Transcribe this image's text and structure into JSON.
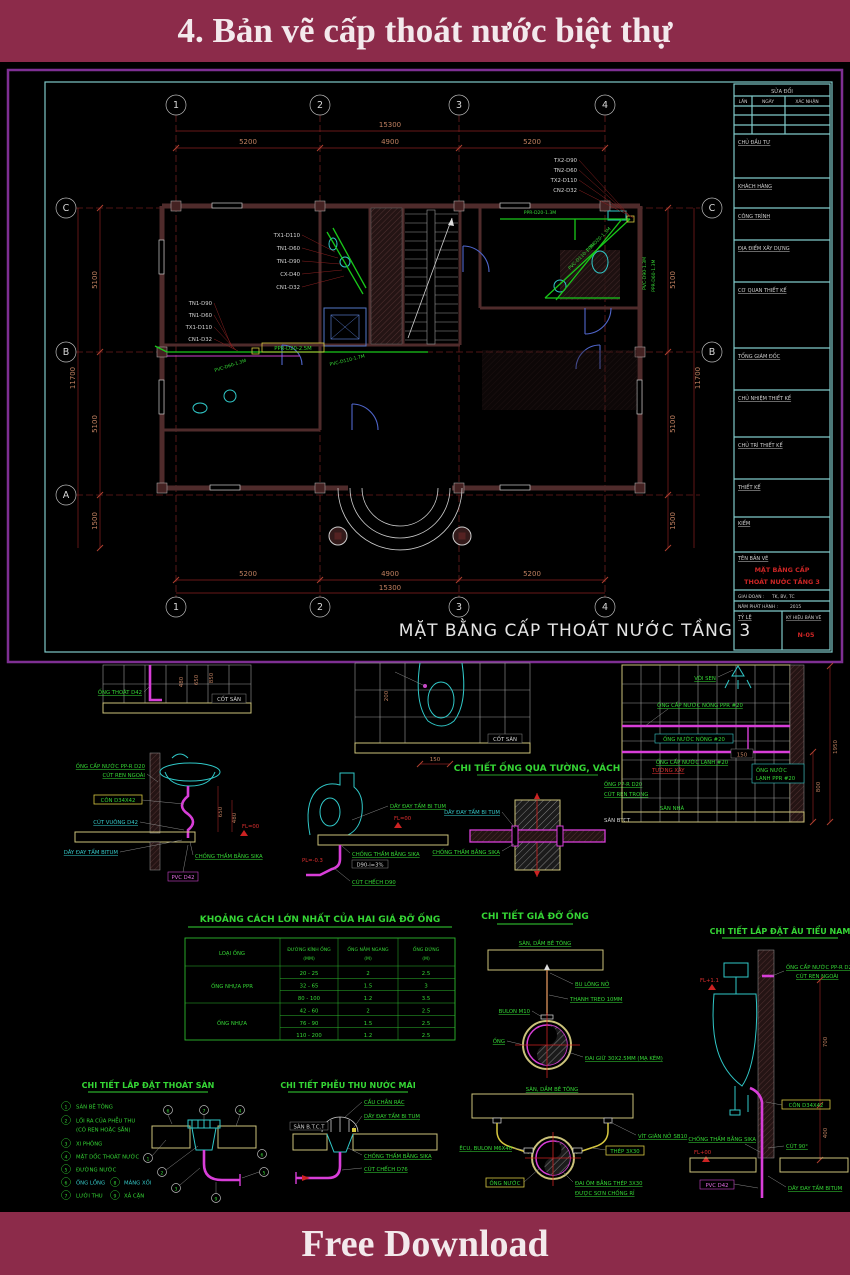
{
  "banner_top": {
    "title": "4. Bản vẽ cấp thoát nước biệt thự"
  },
  "banner_bottom": {
    "title": "Free Download"
  },
  "colors": {
    "banner": "#8c2b4a",
    "sheet_border": "#7e2f93",
    "frame": "#7fc9c9",
    "pipe_green": "#19c819",
    "pipe_magenta": "#d83ed8",
    "fixture_cyan": "#30c8c8",
    "label_green": "#35d635",
    "dim_text": "#c08060",
    "red_text": "#cc2525",
    "slab_yellow": "#cbc27a"
  },
  "titleblock": {
    "revision_header": "SỬA ĐỔI",
    "revision_cols": [
      "LẦN",
      "NGÀY",
      "XÁC NHẬN"
    ],
    "sections": [
      "CHỦ ĐẦU TƯ",
      "KHÁCH HÀNG",
      "CÔNG TRÌNH",
      "ĐỊA ĐIỂM XÂY DỰNG",
      "CƠ QUAN THIẾT KẾ",
      "TỔNG GIÁM ĐỐC",
      "CHỦ NHIỆM THIẾT KẾ",
      "CHỦ TRÌ THIẾT KẾ",
      "THIẾT KẾ",
      "KIỂM"
    ],
    "name_label": "TÊN BẢN VẼ",
    "name_line1": "MẶT BẰNG CẤP",
    "name_line2": "THOÁT NƯỚC TẦNG 3",
    "stage_label": "GIAI ĐOẠN :",
    "stage_value": "TK, BV, TC",
    "year_label": "NĂM PHÁT HÀNH :",
    "year_value": "2015",
    "scale_label": "TỶ LỆ",
    "code_label": "KÝ HIỆU BẢN VẼ",
    "code_value": "N-05"
  },
  "plan": {
    "title": "MẶT BẰNG CẤP THOÁT NƯỚC TẦNG 3",
    "grid_cols": [
      "1",
      "2",
      "3",
      "4"
    ],
    "grid_rows": [
      "C",
      "B",
      "A"
    ],
    "dim_total_h": "15300",
    "dims_h": [
      "5200",
      "4900",
      "5200"
    ],
    "dim_total_v": "11700",
    "dims_v": [
      "5100",
      "5100",
      "1500"
    ],
    "stack1": [
      "TX1-D110",
      "TN1-D60",
      "TN1-D90",
      "CX-D40",
      "CN1-D32"
    ],
    "stack2": [
      "TN1-D90",
      "TN1-D60",
      "TX1-D110",
      "CN1-D32"
    ],
    "stack3": [
      "TX2-D90",
      "TN2-D60",
      "TX2-D110",
      "CN2-D32"
    ],
    "run_label": "PPR-D20-2.5M",
    "diag_label1": "PVC-D60-1.3M",
    "diag_label2": "PVC-D110-1.7M",
    "bath2_top_label": "PPR-D20-1.3M",
    "bath2_diag1": "PVC-D110-1.3M",
    "bath2_diag2": "PPR-D20-1.3M",
    "bath2_right1": "PVC-D90-1.3M",
    "bath2_right2": "PPR-D60-1.3M"
  },
  "d1": {
    "pipe_label": "ỐNG THOÁT D42",
    "floor_label": "CỐT SÀN",
    "dims": [
      "480",
      "650",
      "850"
    ]
  },
  "d2": {
    "supply1": "ỐNG CẤP NƯỚC PP-R D20",
    "supply2": "CÚT REN NGOÀI",
    "cone": "CÔN D34X42",
    "elbow": "CÚT VUÔNG D42",
    "rope": "DÂY ĐAY TẨM BITUM",
    "sika": "CHỐNG THẤM BẰNG SIKA",
    "pvc": "PVC D42",
    "dims": [
      "650",
      "480"
    ],
    "fl": "FL=00"
  },
  "d3": {
    "floor_label": "CỐT SÀN",
    "dim_v": "200",
    "dim_h": "150"
  },
  "d4": {
    "wall": "TƯỜNG XÂY",
    "pipe": "ỐNG PP-R D20",
    "thread": "CÚT REN TRONG",
    "floor": "SÀN BTCT",
    "rope": "DÂY ĐAY TẨM BI TUM",
    "fl": "FL=00",
    "sika": "CHỐNG THẤM BẰNG SIKA",
    "slope": "D90-i=3%",
    "pl": "PL=-0.3",
    "elbow": "CÚT CHẾCH D90"
  },
  "d5": {
    "title": "CHI TIẾT ỐNG QUA TƯỜNG, VÁCH",
    "rope": "DÂY ĐAY TẨM BI TUM",
    "sika": "CHỐNG THẤM BẰNG SIKA"
  },
  "d6": {
    "shower": "VÒI SEN",
    "hot_supply": "ỐNG CẤP NƯỚC NÓNG PPR #20",
    "hot": "ỐNG NƯỚC NÓNG #20",
    "cold_supply": "ỐNG CẤP NƯỚC LẠNH #20",
    "cold1": "ỐNG NƯỚC",
    "cold2": "LẠNH PPR #20",
    "floor": "SÀN NHÀ",
    "dims": [
      "150",
      "800",
      "1950"
    ]
  },
  "support_table": {
    "title": "KHOẢNG CÁCH LỚN NHẤT CỦA HAI GIÁ ĐỠ ỐNG",
    "col1": "LOẠI ỐNG",
    "col2a": "ĐƯỜNG KÍNH ỐNG",
    "col2b": "(MM)",
    "col3a": "ỐNG NẰM NGANG",
    "col3b": "(M)",
    "col4a": "ỐNG ĐỨNG",
    "col4b": "(M)",
    "group1": "ỐNG NHỰA PPR",
    "group2": "ỐNG NHỰA",
    "rows": [
      [
        "20 - 25",
        "2",
        "2.5"
      ],
      [
        "32 - 65",
        "1.5",
        "3"
      ],
      [
        "80 - 100",
        "1.2",
        "3.5"
      ],
      [
        "42 - 60",
        "2",
        "2.5"
      ],
      [
        "76 - 90",
        "1.5",
        "2.5"
      ],
      [
        "110 - 200",
        "1.2",
        "2.5"
      ]
    ]
  },
  "d8": {
    "title": "CHI TIẾT GIÁ ĐỠ ỐNG",
    "slab": "SÀN, DẦM BÊ TÔNG",
    "anchor": "BU LÔNG NỞ",
    "rod": "THANH TREO 10MM",
    "bolt": "BULON M10",
    "pipe": "ỐNG",
    "strap": "ĐAI GIỮ 30X2.5MM (MẠ KẼM)"
  },
  "d9": {
    "title": "CHI TIẾT LẮP ĐẶT ÂU TIỂU NAM",
    "supply1": "ỐNG CẤP NƯỚC PP-R D20",
    "supply2": "CÚT REN NGOÀI",
    "fl_top": "FL+1.1",
    "dims": [
      "700",
      "400"
    ],
    "cone": "CÔN D34X42",
    "sika": "CHỐNG THẤM BẰNG SIKA",
    "elbow": "CÚT 90°",
    "fl_floor": "FL+00",
    "pvc": "PVC D42",
    "rope": "DÂY ĐAY TẨM BITUM"
  },
  "d10": {
    "title": "CHI TIẾT LẮP ĐẶT THOÁT SÀN",
    "items": [
      {
        "num": "1",
        "label": "SÀN BÊ TÔNG"
      },
      {
        "num": "2",
        "label": "LỐI RA CỦA PHỄU THU",
        "label2": "(CÓ REN HOẶC SẴN)"
      },
      {
        "num": "3",
        "label": "XI PHÔNG"
      },
      {
        "num": "4",
        "label": "MẶT DỐC THOÁT NƯỚC"
      },
      {
        "num": "5",
        "label": "ĐƯỜNG NƯỚC"
      },
      {
        "num": "6",
        "label": "ỐNG LỒNG"
      },
      {
        "num": "7",
        "label": "LƯỚI THU"
      },
      {
        "num": "8",
        "label": "MÁNG XỐI"
      },
      {
        "num": "9",
        "label": "XẢ CẶN"
      }
    ],
    "callouts": [
      "6",
      "7",
      "4",
      "1",
      "2",
      "3",
      "6",
      "5",
      "9"
    ]
  },
  "d11": {
    "title": "CHI TIẾT PHỄU THU NƯỚC MÁI",
    "strainer": "CẦU CHẮN RÁC",
    "slab": "SÀN B.T.C.T",
    "rope": "DÂY ĐAY TẨM BI TUM",
    "sika": "CHỐNG THẤM BẰNG SIKA",
    "elbow": "CÚT CHẾCH D76"
  },
  "d12": {
    "slab": "SÀN, DẦM BÊ TÔNG",
    "anchor": "VÍT GIÃN NỞ SB10",
    "nut": "ÊCU, BULON M6X40",
    "steel": "THÉP 3X30",
    "pipe": "ỐNG NƯỚC",
    "strap1": "ĐAI ÔM BẰNG THÉP 3X30",
    "strap2": "ĐƯỢC SƠN CHỐNG RỈ"
  }
}
